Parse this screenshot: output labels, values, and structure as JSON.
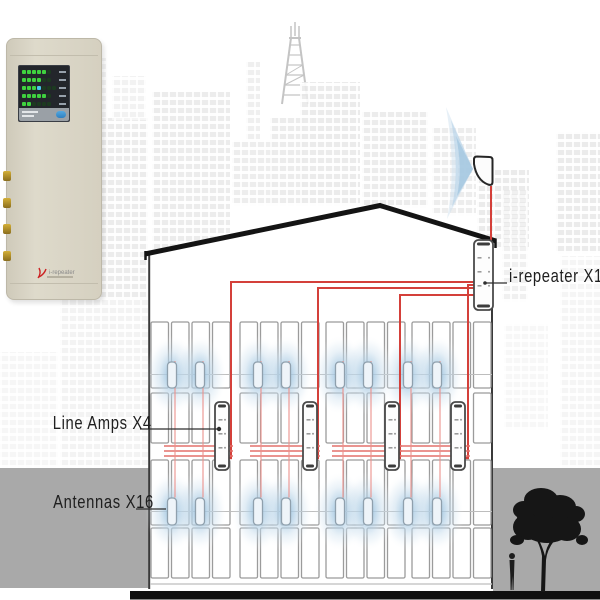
{
  "labels": {
    "repeater": "i-repeater X1",
    "line_amps": "Line Amps X4",
    "antennas": "Antennas X16"
  },
  "device_photo": {
    "logo_text": "i-repeater",
    "led_rows": [
      5,
      4,
      3,
      5,
      2
    ],
    "cyan_row": 2
  },
  "colors": {
    "cable_red": "#d4403a",
    "cable_light_red": "#ec928d",
    "glow_blue": "#a9cbe3",
    "ground_gray": "#a9a9a9",
    "device_beige": "#d5d0c0",
    "silhouette": "#161616"
  },
  "system": {
    "repeater_count": 1,
    "amp_count": 4,
    "antenna_count": 16,
    "window_groups_x": [
      151,
      240,
      326,
      412
    ],
    "window_pitch": 20.5,
    "window_w": 17.5,
    "window_rows": [
      {
        "y": 322,
        "h": 66
      },
      {
        "y": 393,
        "h": 50,
        "amp_row": true
      },
      {
        "y": 460,
        "h": 65
      },
      {
        "y": 528,
        "h": 50
      }
    ],
    "floor_lines_y": [
      374.5,
      511.5
    ],
    "amps": {
      "y": 402,
      "h": 68,
      "w": 14,
      "cx": [
        222,
        310,
        392,
        458
      ],
      "skip_window": [
        3,
        3,
        3,
        2
      ]
    },
    "antenna_pairs": [
      [
        172,
        200
      ],
      [
        258,
        286
      ],
      [
        340,
        368
      ],
      [
        408,
        437
      ]
    ],
    "antenna_rows": [
      {
        "y": 362,
        "h": 26
      },
      {
        "y": 498,
        "h": 27
      }
    ],
    "trunks": [
      {
        "y": 282,
        "drop_x": 231
      },
      {
        "y": 288,
        "drop_x": 318
      },
      {
        "y": 295,
        "drop_x": 400
      },
      {
        "y": 285,
        "drop_x": 468
      }
    ],
    "bundle_ys": [
      446,
      451,
      456
    ],
    "repeater_box": {
      "x": 474,
      "y": 240,
      "w": 19,
      "h": 70
    },
    "donor_cable_x": 491
  }
}
